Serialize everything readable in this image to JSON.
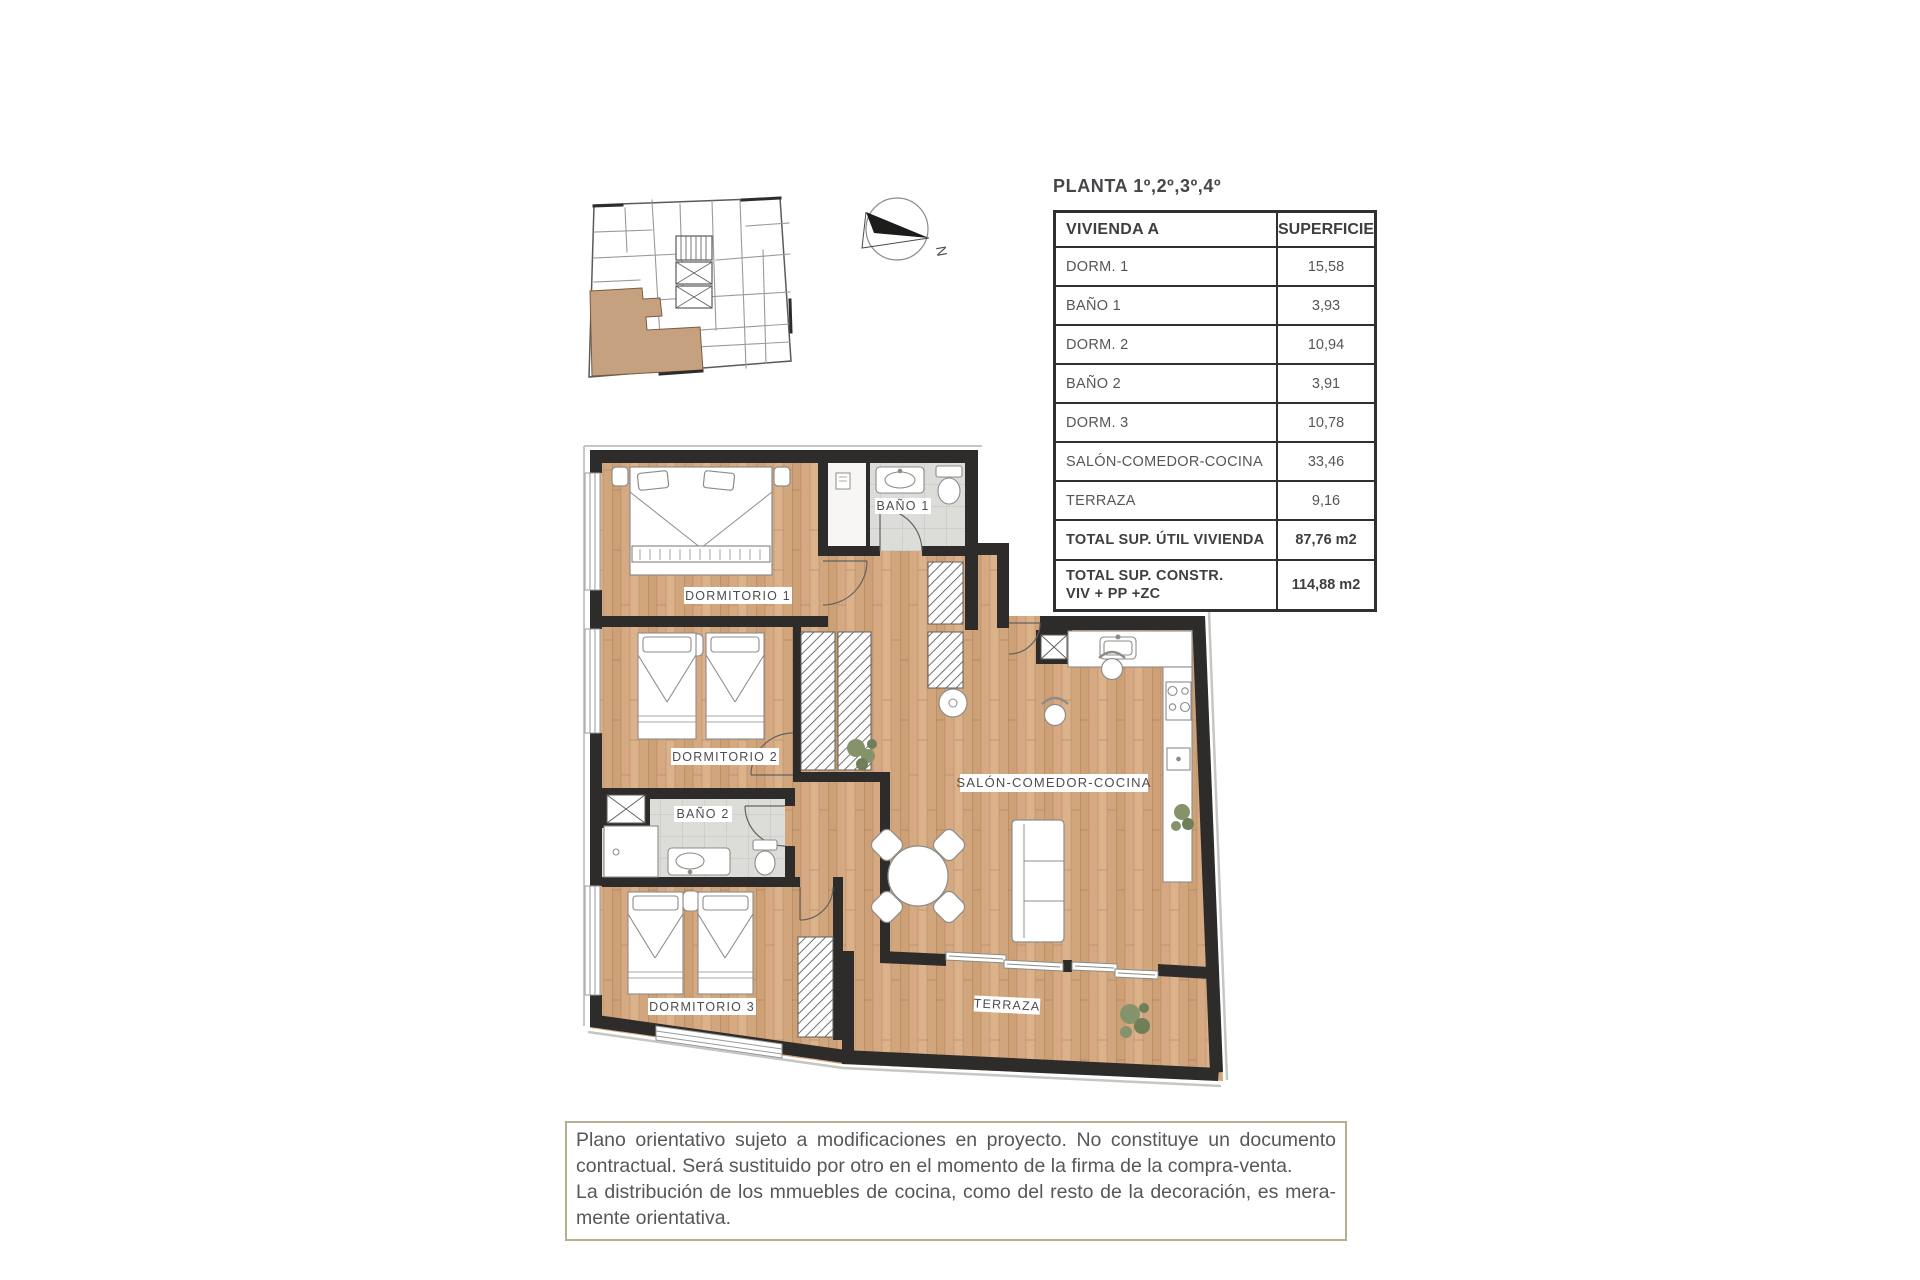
{
  "page": {
    "title": "PLANTA 1º,2º,3º,4º"
  },
  "table": {
    "header": {
      "col1": "VIVIENDA A",
      "col2": "SUPERFICIE"
    },
    "rows": [
      {
        "label": "DORM. 1",
        "value": "15,58"
      },
      {
        "label": "BAÑO 1",
        "value": "3,93"
      },
      {
        "label": "DORM. 2",
        "value": "10,94"
      },
      {
        "label": "BAÑO 2",
        "value": "3,91"
      },
      {
        "label": "DORM. 3",
        "value": "10,78"
      },
      {
        "label": "SALÓN-COMEDOR-COCINA",
        "value": "33,46"
      },
      {
        "label": "TERRAZA",
        "value": "9,16"
      }
    ],
    "totals": [
      {
        "label": "TOTAL SUP. ÚTIL VIVIENDA",
        "value": "87,76 m2"
      },
      {
        "label": "TOTAL SUP. CONSTR.\nVIV + PP +ZC",
        "value": "114,88 m2"
      }
    ]
  },
  "plan": {
    "rooms": {
      "dormitorio1": "DORMITORIO 1",
      "bano1": "BAÑO 1",
      "dormitorio2": "DORMITORIO 2",
      "bano2": "BAÑO 2",
      "dormitorio3": "DORMITORIO 3",
      "salon": "SALÓN-COMEDOR-COCINA",
      "terraza": "TERRAZA"
    },
    "compass": {
      "label": "N"
    }
  },
  "disclaimer": {
    "line1": "Plano orientativo sujeto a modificaciones en proyecto. No constituye un documento",
    "line2": "contractual. Será sustituido por otro en el momento de la firma de la compra-venta.",
    "line3": "La distribución de los mmuebles de cocina, como del resto de la decoración, es mera-",
    "line4": "mente orientativa."
  },
  "colors": {
    "wall": "#2d2c2b",
    "wood": "#d6a982",
    "tile": "#dcdcd8",
    "highlight_unit": "#c6a180",
    "table_border": "#2f3032",
    "disclaimer_border": "#b6ae93",
    "text": "#55565a"
  }
}
